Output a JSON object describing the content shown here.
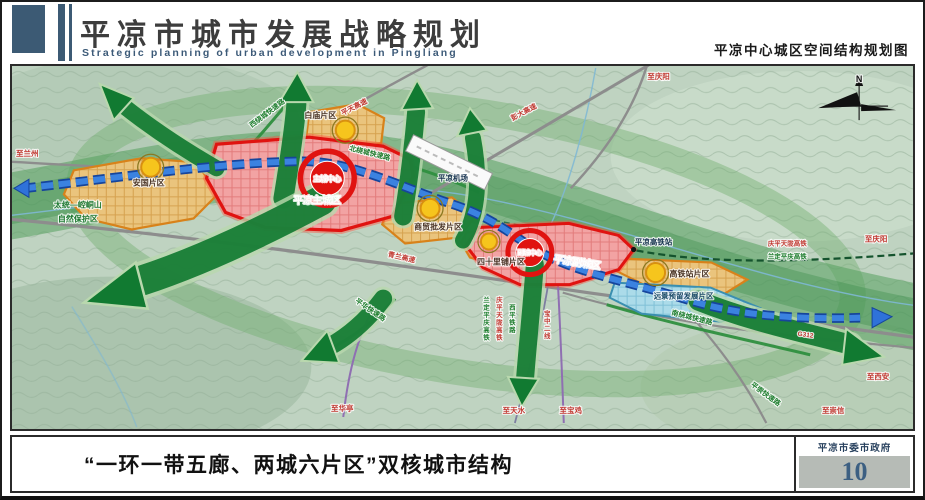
{
  "header": {
    "title": "平凉市城市发展战略规划",
    "subtitle_en": "Strategic planning of urban development in Pingliang",
    "map_title": "平凉中心城区空间结构规划图"
  },
  "footer": {
    "caption": "“一环一带五廊、两城六片区”双核城市结构",
    "agency": "平凉市委市政府",
    "page_number": "10"
  },
  "map": {
    "compass": "N",
    "cities": {
      "main_city": "平凉主城区",
      "sub_city": "平凉副城区",
      "main_core": "主城中心",
      "sub_core": "副城中心"
    },
    "districts": {
      "anguo": "安国片区",
      "baimiao": "白庙片区",
      "trade": "商贸批发片区",
      "sishilipu": "四十里铺片区",
      "hsr": "高铁站片区",
      "reserved": "远景预留发展片区"
    },
    "roads": {
      "pengda": "彭大高速",
      "pingtian": "平天高速",
      "qinglan": "青兰高速",
      "g312": "G312",
      "west_ring": "西绕城快速路",
      "north_ring": "北绕城快速路",
      "south_ring": "南绕城快速路",
      "pinghua": "平华快速路",
      "pingchong": "平崇快速路"
    },
    "rails": {
      "station": "平凉高铁站",
      "qptl": "庆平天陇高铁",
      "ldpq": "兰定平庆高铁",
      "xiping": "西平铁路",
      "baozhong": "宝中二线"
    },
    "directions": {
      "lanzhou": "至兰州",
      "qingyang_n": "至庆阳",
      "qingyang_e": "至庆阳",
      "xian": "至西安",
      "chongxin": "至崇信",
      "baoji": "至宝鸡",
      "tianshui": "至天水",
      "huating": "至华亭"
    },
    "nature": {
      "line1": "太统—崆峒山",
      "line2": "自然保护区"
    },
    "airport": "平凉机场"
  },
  "colors": {
    "accent_blue": "#3c5a74",
    "core_red": "#e01310",
    "node_yellow": "#f6c51d",
    "corridor_green": "#117a31",
    "transit_blue": "#3b82e0"
  }
}
